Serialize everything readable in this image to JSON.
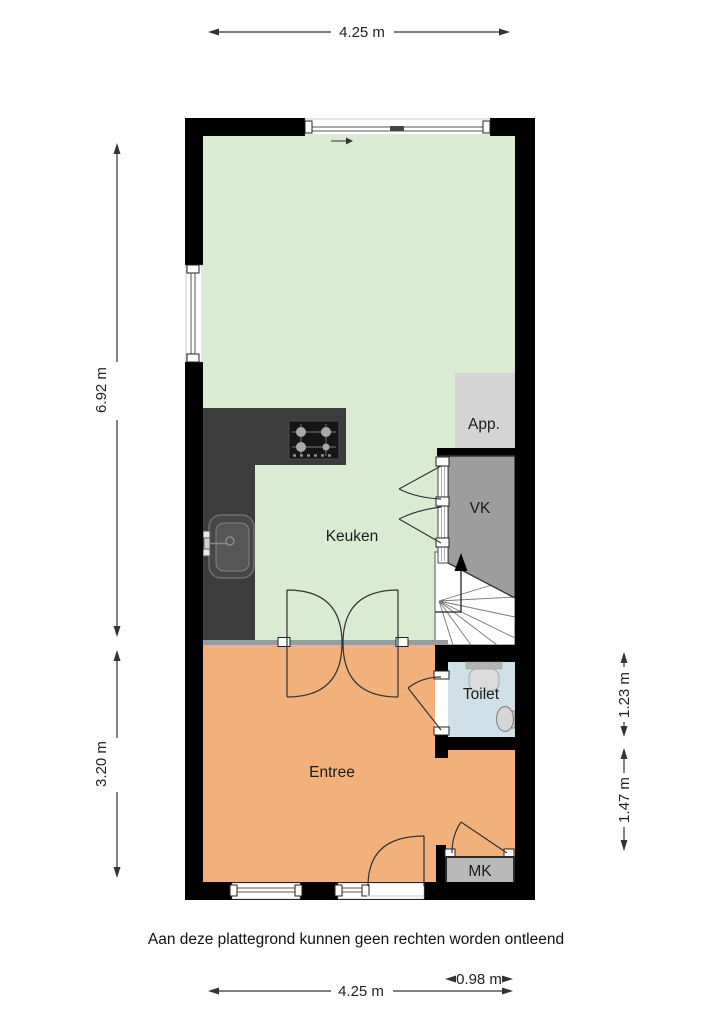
{
  "plan": {
    "rooms": {
      "keuken": "Keuken",
      "entree": "Entree",
      "toilet": "Toilet",
      "vk": "VK",
      "app": "App.",
      "mk": "MK"
    },
    "dimensions": {
      "top_width": "4.25 m",
      "left_upper": "6.92 m",
      "left_lower": "3.20 m",
      "right_upper": "1.23 m",
      "right_lower": "1.47 m",
      "bottom_width": "4.25 m",
      "bottom_right": "0.98 m"
    },
    "disclaimer": "Aan deze plattegrond kunnen geen rechten worden ontleend",
    "colors": {
      "wall": "#000000",
      "floor_keuken": "#d9ecd2",
      "floor_entree": "#f2b17b",
      "floor_toilet": "#cfe0e8",
      "vk_fill": "#9d9d9d",
      "app_fill": "#d4d4d4",
      "mk_fill": "#b9b9b9",
      "counter": "#3c3c3c",
      "divider": "#9b9b9b",
      "stairs": "#ffffff"
    }
  }
}
